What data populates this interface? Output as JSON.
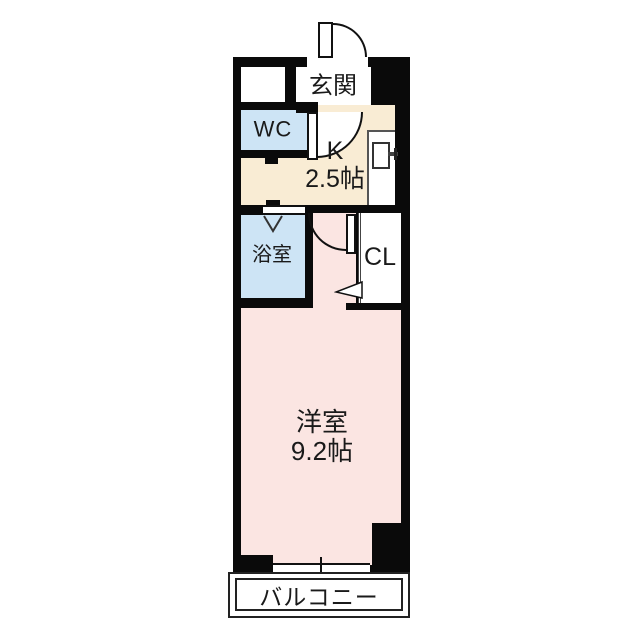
{
  "floorplan": {
    "type": "apartment-floor-plan",
    "rooms": {
      "genkan": {
        "label": "玄関"
      },
      "wc": {
        "label": "WC"
      },
      "kitchen": {
        "label": "K",
        "size": "2.5帖"
      },
      "bathroom": {
        "label": "浴室"
      },
      "closet": {
        "label": "CL"
      },
      "main_room": {
        "label": "洋室",
        "size": "9.2帖"
      },
      "balcony": {
        "label": "バルコニー"
      }
    },
    "colors": {
      "wall": "#0a0a0a",
      "kitchen_floor": "#f9ecd4",
      "wet_area": "#cde4f5",
      "room_floor": "#fbe5e2"
    }
  }
}
